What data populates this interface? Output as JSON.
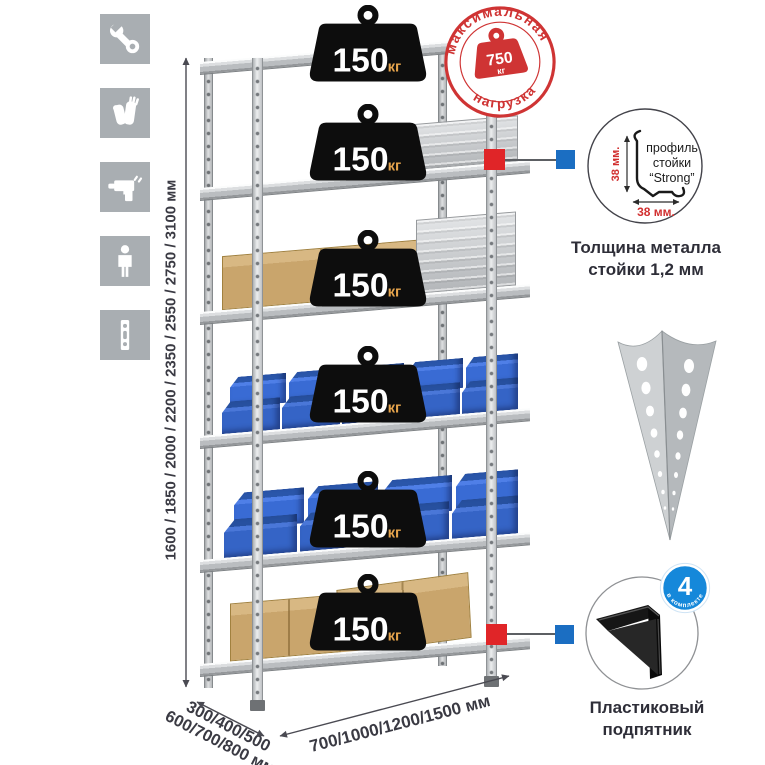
{
  "colors": {
    "stamp_red": "#cf3434",
    "connector_red": "#e02528",
    "connector_blue": "#1b6ec2",
    "badge_blue": "#1588da",
    "bin_blue": "#3564c6",
    "icon_gray": "#a9aeb2",
    "weight_black": "#0d0d0d",
    "unit_orange": "#e5a34c"
  },
  "left_toolbar": {
    "icons": [
      {
        "name": "wrench-icon"
      },
      {
        "name": "gloves-icon"
      },
      {
        "name": "drill-icon"
      },
      {
        "name": "person-icon"
      },
      {
        "name": "post-profile-icon"
      }
    ]
  },
  "dimensions": {
    "height": "1600 / 1850 / 2000 / 2200 / 2350 / 2550 / 2750 / 3100 мм",
    "depth_line1": "300/400/500",
    "depth_line2": "600/700/800 мм",
    "width": "700/1000/1200/1500 мм"
  },
  "shelves": {
    "weights": [
      {
        "value": "150",
        "unit": "кг"
      },
      {
        "value": "150",
        "unit": "кг"
      },
      {
        "value": "150",
        "unit": "кг"
      },
      {
        "value": "150",
        "unit": "кг"
      },
      {
        "value": "150",
        "unit": "кг"
      },
      {
        "value": "150",
        "unit": "кг"
      }
    ]
  },
  "max_load_stamp": {
    "arc_top": "максимальная",
    "arc_bottom": "нагрузка",
    "value": "750",
    "unit": "кг"
  },
  "profile_detail": {
    "line1": "профиль",
    "line2": "стойки",
    "line3": "“Strong”",
    "dim_vertical": "38 мм.",
    "dim_horizontal": "38 мм.",
    "caption1": "Толщина металла",
    "caption2": "стойки 1,2 мм"
  },
  "foot_detail": {
    "badge_value": "4",
    "badge_arc": "в комплекте",
    "caption1": "Пластиковый",
    "caption2": "подпятник"
  }
}
